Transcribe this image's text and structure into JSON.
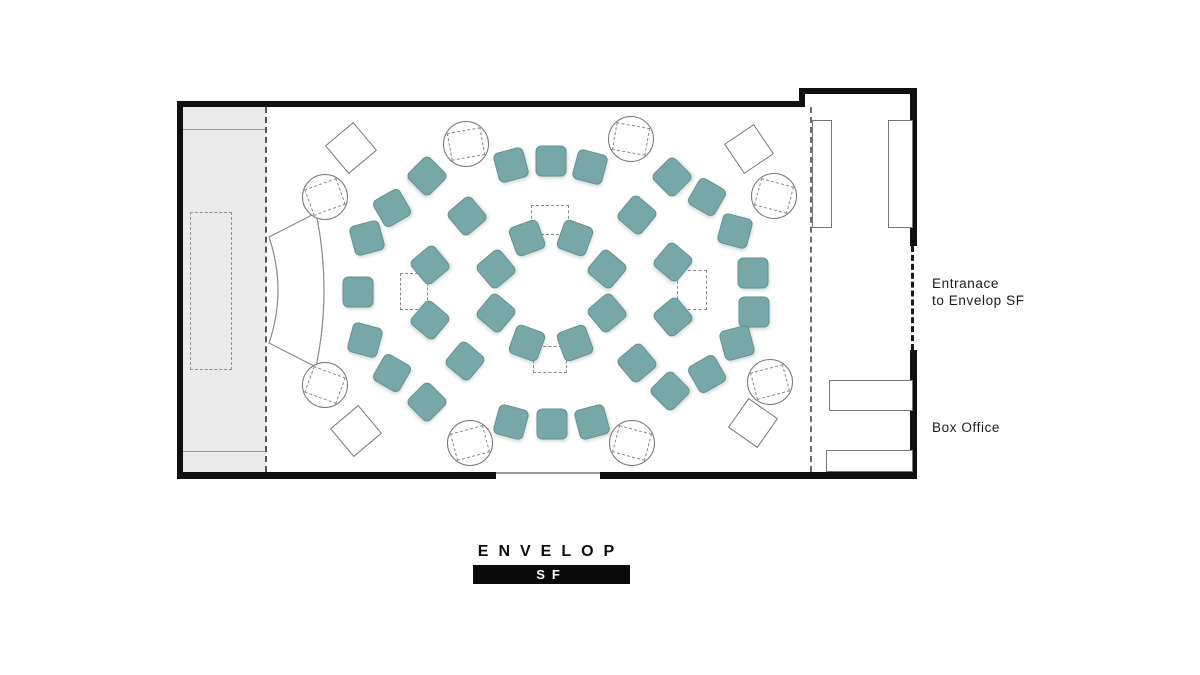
{
  "labels": {
    "entrance_line1": "Entranace",
    "entrance_line2": "to Envelop SF",
    "box_office": "Box Office"
  },
  "logo": {
    "wordmark": "ENVELOP",
    "badge": "SF"
  },
  "colors": {
    "seat_teal": "#78a7a7",
    "wall_black": "#101010",
    "stage_gray": "#eaeaea",
    "outline_gray": "#8a8a8a"
  },
  "floorplan": {
    "seats": [
      {
        "x": 527,
        "y": 238,
        "r": -20
      },
      {
        "x": 575,
        "y": 238,
        "r": 20
      },
      {
        "x": 496,
        "y": 269,
        "r": -40
      },
      {
        "x": 607,
        "y": 269,
        "r": 40
      },
      {
        "x": 496,
        "y": 313,
        "r": 40
      },
      {
        "x": 607,
        "y": 313,
        "r": -40
      },
      {
        "x": 527,
        "y": 343,
        "r": 20
      },
      {
        "x": 575,
        "y": 343,
        "r": -20
      },
      {
        "x": 511,
        "y": 165,
        "r": -15
      },
      {
        "x": 551,
        "y": 161,
        "r": 0
      },
      {
        "x": 590,
        "y": 167,
        "r": 15
      },
      {
        "x": 467,
        "y": 216,
        "r": -40
      },
      {
        "x": 637,
        "y": 215,
        "r": 40
      },
      {
        "x": 430,
        "y": 265,
        "r": -40
      },
      {
        "x": 673,
        "y": 262,
        "r": 40
      },
      {
        "x": 430,
        "y": 320,
        "r": 40
      },
      {
        "x": 673,
        "y": 317,
        "r": -40
      },
      {
        "x": 465,
        "y": 361,
        "r": 40
      },
      {
        "x": 637,
        "y": 363,
        "r": -40
      },
      {
        "x": 511,
        "y": 422,
        "r": 15
      },
      {
        "x": 552,
        "y": 424,
        "r": 0
      },
      {
        "x": 592,
        "y": 422,
        "r": -15
      },
      {
        "x": 427,
        "y": 176,
        "r": 45
      },
      {
        "x": 392,
        "y": 208,
        "r": -30
      },
      {
        "x": 367,
        "y": 238,
        "r": -15
      },
      {
        "x": 358,
        "y": 292,
        "r": 0
      },
      {
        "x": 365,
        "y": 340,
        "r": 15
      },
      {
        "x": 392,
        "y": 373,
        "r": 30
      },
      {
        "x": 427,
        "y": 402,
        "r": 45
      },
      {
        "x": 672,
        "y": 177,
        "r": -45
      },
      {
        "x": 707,
        "y": 197,
        "r": 30
      },
      {
        "x": 735,
        "y": 231,
        "r": 15
      },
      {
        "x": 753,
        "y": 273,
        "r": 0
      },
      {
        "x": 754,
        "y": 312,
        "r": 0
      },
      {
        "x": 737,
        "y": 343,
        "r": -15
      },
      {
        "x": 707,
        "y": 374,
        "r": -30
      },
      {
        "x": 670,
        "y": 391,
        "r": -45
      }
    ],
    "speakers": [
      {
        "x": 325,
        "y": 197,
        "rot": -20
      },
      {
        "x": 466,
        "y": 144,
        "rot": -10
      },
      {
        "x": 631,
        "y": 139,
        "rot": 10
      },
      {
        "x": 774,
        "y": 196,
        "rot": 15
      },
      {
        "x": 325,
        "y": 385,
        "rot": 20
      },
      {
        "x": 470,
        "y": 443,
        "rot": -15
      },
      {
        "x": 632,
        "y": 443,
        "rot": 15
      },
      {
        "x": 770,
        "y": 382,
        "rot": -15
      }
    ],
    "monitors": [
      {
        "x": 351,
        "y": 148,
        "s": 37,
        "rot": 50
      },
      {
        "x": 749,
        "y": 149,
        "s": 36,
        "rot": 56
      },
      {
        "x": 356,
        "y": 431,
        "s": 37,
        "rot": 50
      },
      {
        "x": 753,
        "y": 423,
        "s": 36,
        "rot": 35
      }
    ],
    "sub_markers": [
      {
        "x": 550,
        "y": 220,
        "w": 38,
        "h": 30
      },
      {
        "x": 550,
        "y": 359,
        "w": 34,
        "h": 27
      },
      {
        "x": 414,
        "y": 291,
        "w": 28,
        "h": 37
      },
      {
        "x": 692,
        "y": 290,
        "w": 30,
        "h": 40
      }
    ],
    "benches": [
      {
        "x": 812,
        "y": 120,
        "w": 20,
        "h": 108
      },
      {
        "x": 888,
        "y": 120,
        "w": 25,
        "h": 108
      },
      {
        "x": 829,
        "y": 380,
        "w": 84,
        "h": 31
      },
      {
        "x": 826,
        "y": 450,
        "w": 87,
        "h": 22
      }
    ]
  }
}
